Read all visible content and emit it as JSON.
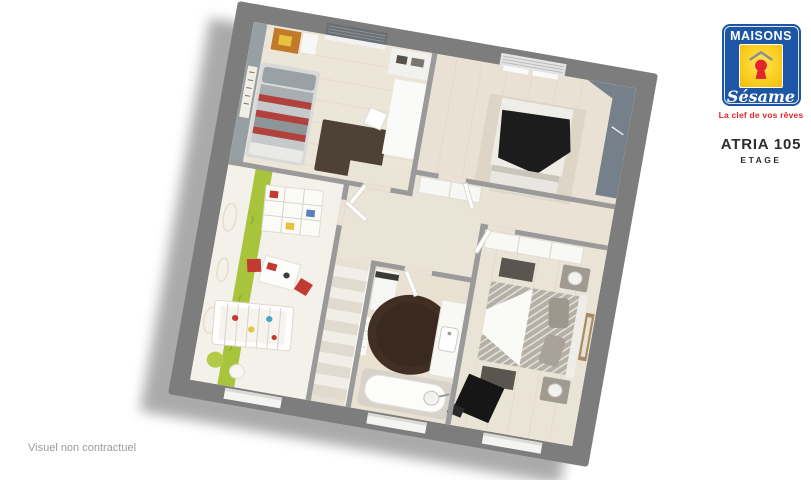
{
  "brand": {
    "name_top": "MAISONS",
    "name_script": "Sésame",
    "tagline": "La clef de vos rêves"
  },
  "plan": {
    "model": "ATRIA 105",
    "floor": "ETAGE",
    "caption": "Visuel non contractuel"
  },
  "colors": {
    "brand_blue": "#1d56a4",
    "brand_yellow": "#f2bd0a",
    "brand_red": "#e2262b",
    "wall_grey": "#7d7d7d",
    "inner_wall_grey": "#9a9a9a",
    "floor_beige": "#eae3d5",
    "accent_green": "#a8c33c",
    "rug_brown": "#412f23",
    "bed1_red": "#b0413c",
    "text_dark": "#2d2d2d",
    "text_grey": "#9a9a9a"
  }
}
